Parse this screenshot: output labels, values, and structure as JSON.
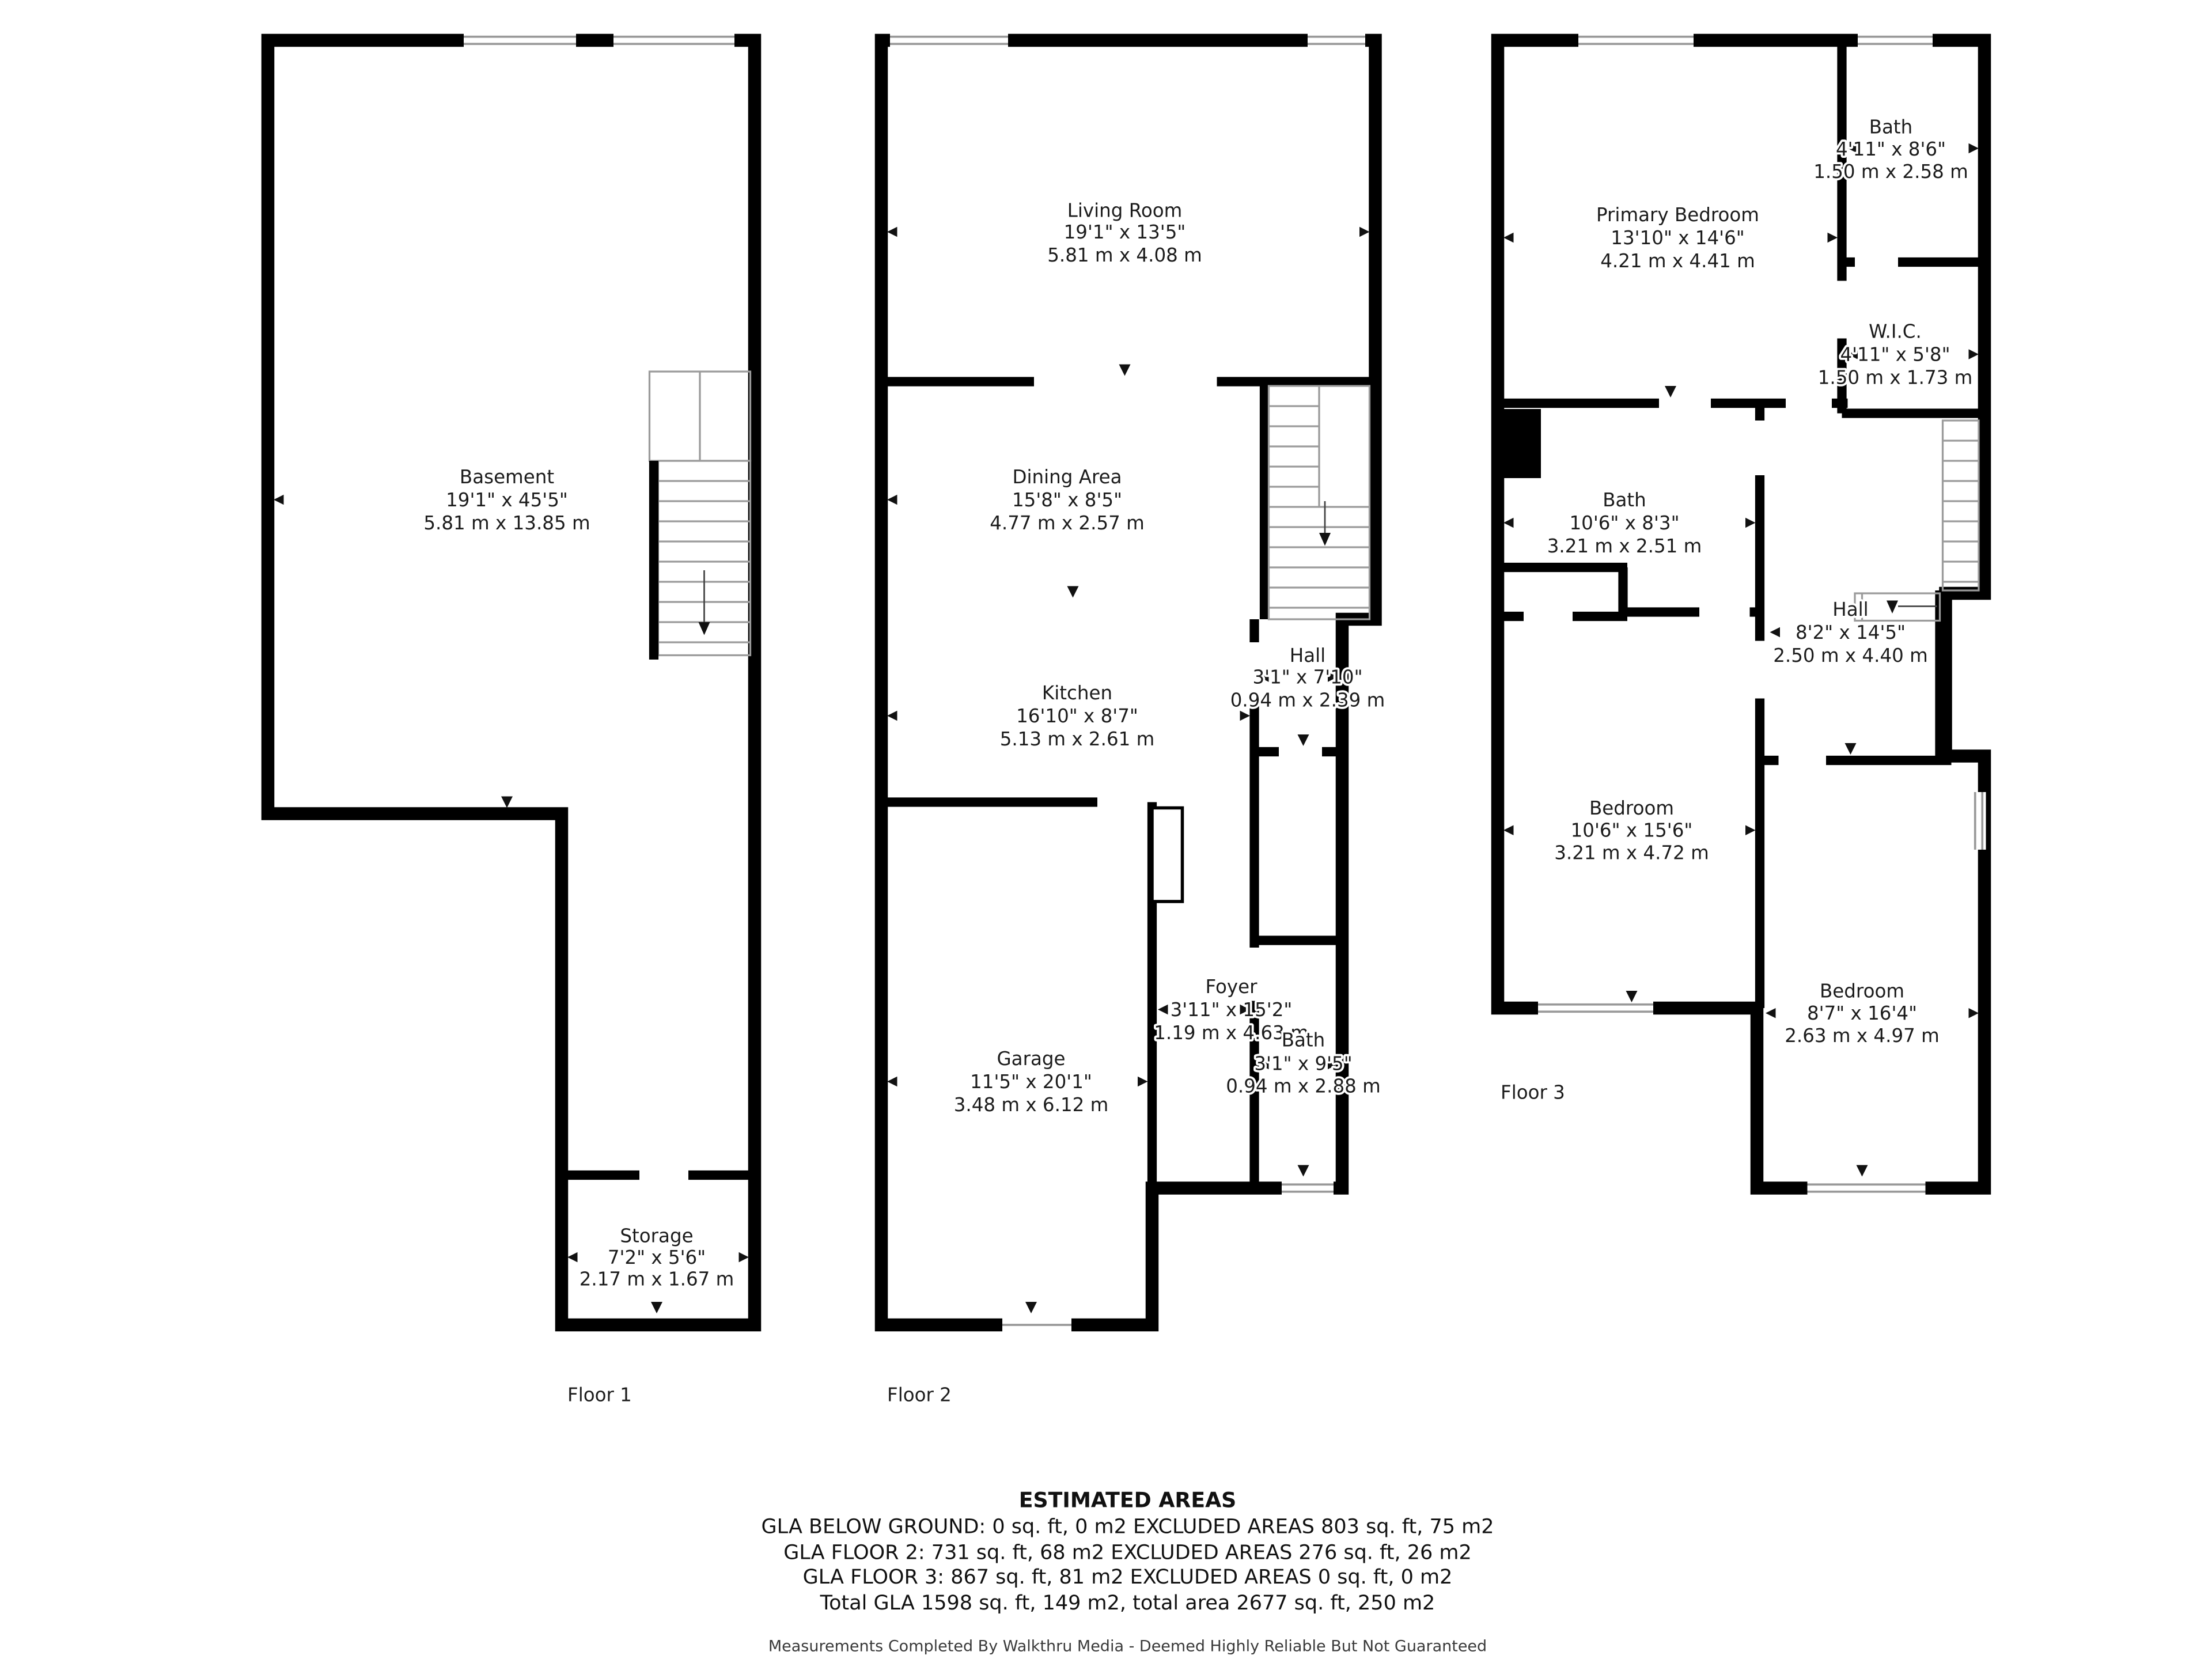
{
  "floors": [
    {
      "label": "Floor 1",
      "rooms": [
        {
          "name": "Basement",
          "imperial": "19'1\" x 45'5\"",
          "metric": "5.81 m x 13.85 m"
        },
        {
          "name": "Storage",
          "imperial": "7'2\" x 5'6\"",
          "metric": "2.17 m x 1.67 m"
        }
      ]
    },
    {
      "label": "Floor 2",
      "rooms": [
        {
          "name": "Living Room",
          "imperial": "19'1\" x 13'5\"",
          "metric": "5.81 m x 4.08 m"
        },
        {
          "name": "Dining Area",
          "imperial": "15'8\" x 8'5\"",
          "metric": "4.77 m x 2.57 m"
        },
        {
          "name": "Kitchen",
          "imperial": "16'10\" x 8'7\"",
          "metric": "5.13 m x 2.61 m"
        },
        {
          "name": "Hall",
          "imperial": "3'1\" x 7'10\"",
          "metric": "0.94 m x 2.39 m"
        },
        {
          "name": "Garage",
          "imperial": "11'5\" x 20'1\"",
          "metric": "3.48 m x 6.12 m"
        },
        {
          "name": "Foyer",
          "imperial": "3'11\" x 15'2\"",
          "metric": "1.19 m x 4.63 m"
        },
        {
          "name": "Bath",
          "imperial": "3'1\" x 9'5\"",
          "metric": "0.94 m x 2.88 m"
        }
      ]
    },
    {
      "label": "Floor 3",
      "rooms": [
        {
          "name": "Bath",
          "imperial": "4'11\" x 8'6\"",
          "metric": "1.50 m x 2.58 m"
        },
        {
          "name": "Primary Bedroom",
          "imperial": "13'10\" x 14'6\"",
          "metric": "4.21 m x 4.41 m"
        },
        {
          "name": "W.I.C.",
          "imperial": "4'11\" x 5'8\"",
          "metric": "1.50 m x 1.73 m"
        },
        {
          "name": "Bath",
          "imperial": "10'6\" x 8'3\"",
          "metric": "3.21 m x 2.51 m"
        },
        {
          "name": "Hall",
          "imperial": "8'2\" x 14'5\"",
          "metric": "2.50 m x 4.40 m"
        },
        {
          "name": "Bedroom",
          "imperial": "10'6\" x 15'6\"",
          "metric": "3.21 m x 4.72 m"
        },
        {
          "name": "Bedroom",
          "imperial": "8'7\" x 16'4\"",
          "metric": "2.63 m x 4.97 m"
        }
      ]
    }
  ],
  "estimated_areas": {
    "title": "ESTIMATED AREAS",
    "lines": [
      "GLA BELOW GROUND: 0 sq. ft, 0 m2 EXCLUDED AREAS 803 sq. ft, 75 m2",
      "GLA FLOOR 2: 731 sq. ft, 68 m2 EXCLUDED AREAS 276 sq. ft, 26 m2",
      "GLA FLOOR 3: 867 sq. ft, 81 m2 EXCLUDED AREAS 0 sq. ft, 0 m2",
      "Total GLA 1598 sq. ft, 149 m2, total area 2677 sq. ft, 250 m2"
    ]
  },
  "disclaimer": "Measurements Completed By Walkthru Media - Deemed Highly Reliable But Not Guaranteed"
}
